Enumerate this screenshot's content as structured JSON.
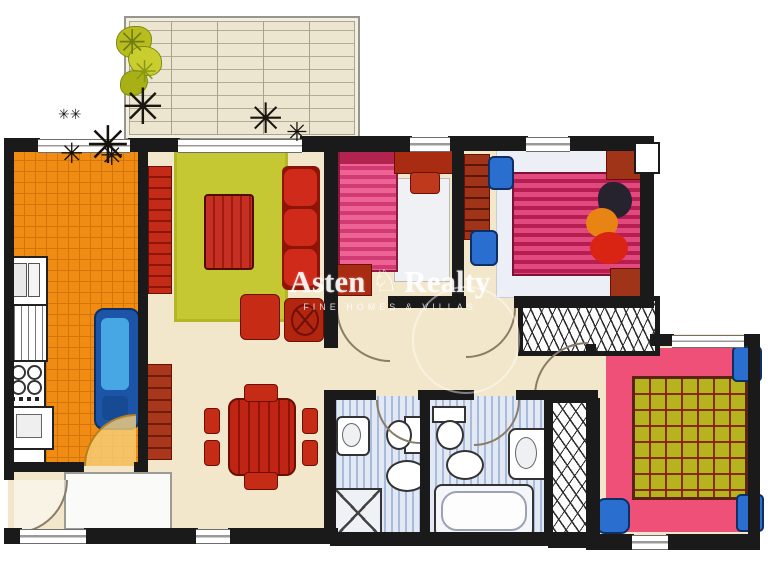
{
  "watermark": {
    "brand_left": "Asten",
    "brand_right": "Realty",
    "logo_glyph": "♘",
    "tagline": "FINE HOMES & VILLAS"
  },
  "palette": {
    "wall": "#1a1a1a",
    "floor_cream": "#f3e7cb",
    "terrace": "#ece6d0",
    "kitchen_tile_orange": "#f08c13",
    "living_rug_green": "#c5c832",
    "red_furniture": "#c62b16",
    "dark_red_wood": "#a33418",
    "pink_bed": "#e8528a",
    "pink_rug": "#ee5078",
    "bed_blanket_green": "#b6b41e",
    "blue_furniture": "#2a6fd0",
    "bathroom_floor": "#e3e9f4",
    "plant_dark": "#17140e",
    "plant_green": "#b8bc1f"
  },
  "rooms": [
    {
      "name": "terrace",
      "features": [
        "pergola-grid",
        "railing",
        "plants"
      ]
    },
    {
      "name": "kitchen",
      "features": [
        "sink",
        "oven",
        "stove-4-burners",
        "washing-machine",
        "blue-table-with-bench",
        "orange-tiled-floor",
        "door-swing"
      ]
    },
    {
      "name": "living-dining-room",
      "features": [
        "green-area-rug",
        "coffee-table",
        "three-seat-sofa",
        "two-armchairs",
        "sideboards",
        "dining-table-with-six-chairs",
        "entrance-rug"
      ]
    },
    {
      "name": "bedroom-1",
      "features": [
        "single-bed",
        "desk",
        "chair",
        "rug",
        "cabinet"
      ]
    },
    {
      "name": "bedroom-2",
      "features": [
        "double-bed",
        "cushions",
        "wardrobe",
        "blue-chairs",
        "nightstands",
        "built-in-closet"
      ]
    },
    {
      "name": "bedroom-3",
      "features": [
        "double-bed-green-blanket",
        "pink-rug",
        "blue-nightstands",
        "blue-chair",
        "pillows"
      ]
    },
    {
      "name": "bathroom-1",
      "features": [
        "washbasin",
        "toilet",
        "bidet",
        "shower-tray"
      ]
    },
    {
      "name": "bathroom-2",
      "features": [
        "toilet",
        "bidet",
        "washbasin",
        "bathtub"
      ]
    },
    {
      "name": "walk-in-wardrobe",
      "features": [
        "hanging-rail-hatching"
      ]
    },
    {
      "name": "hallway",
      "features": [
        "door-swings"
      ]
    }
  ]
}
